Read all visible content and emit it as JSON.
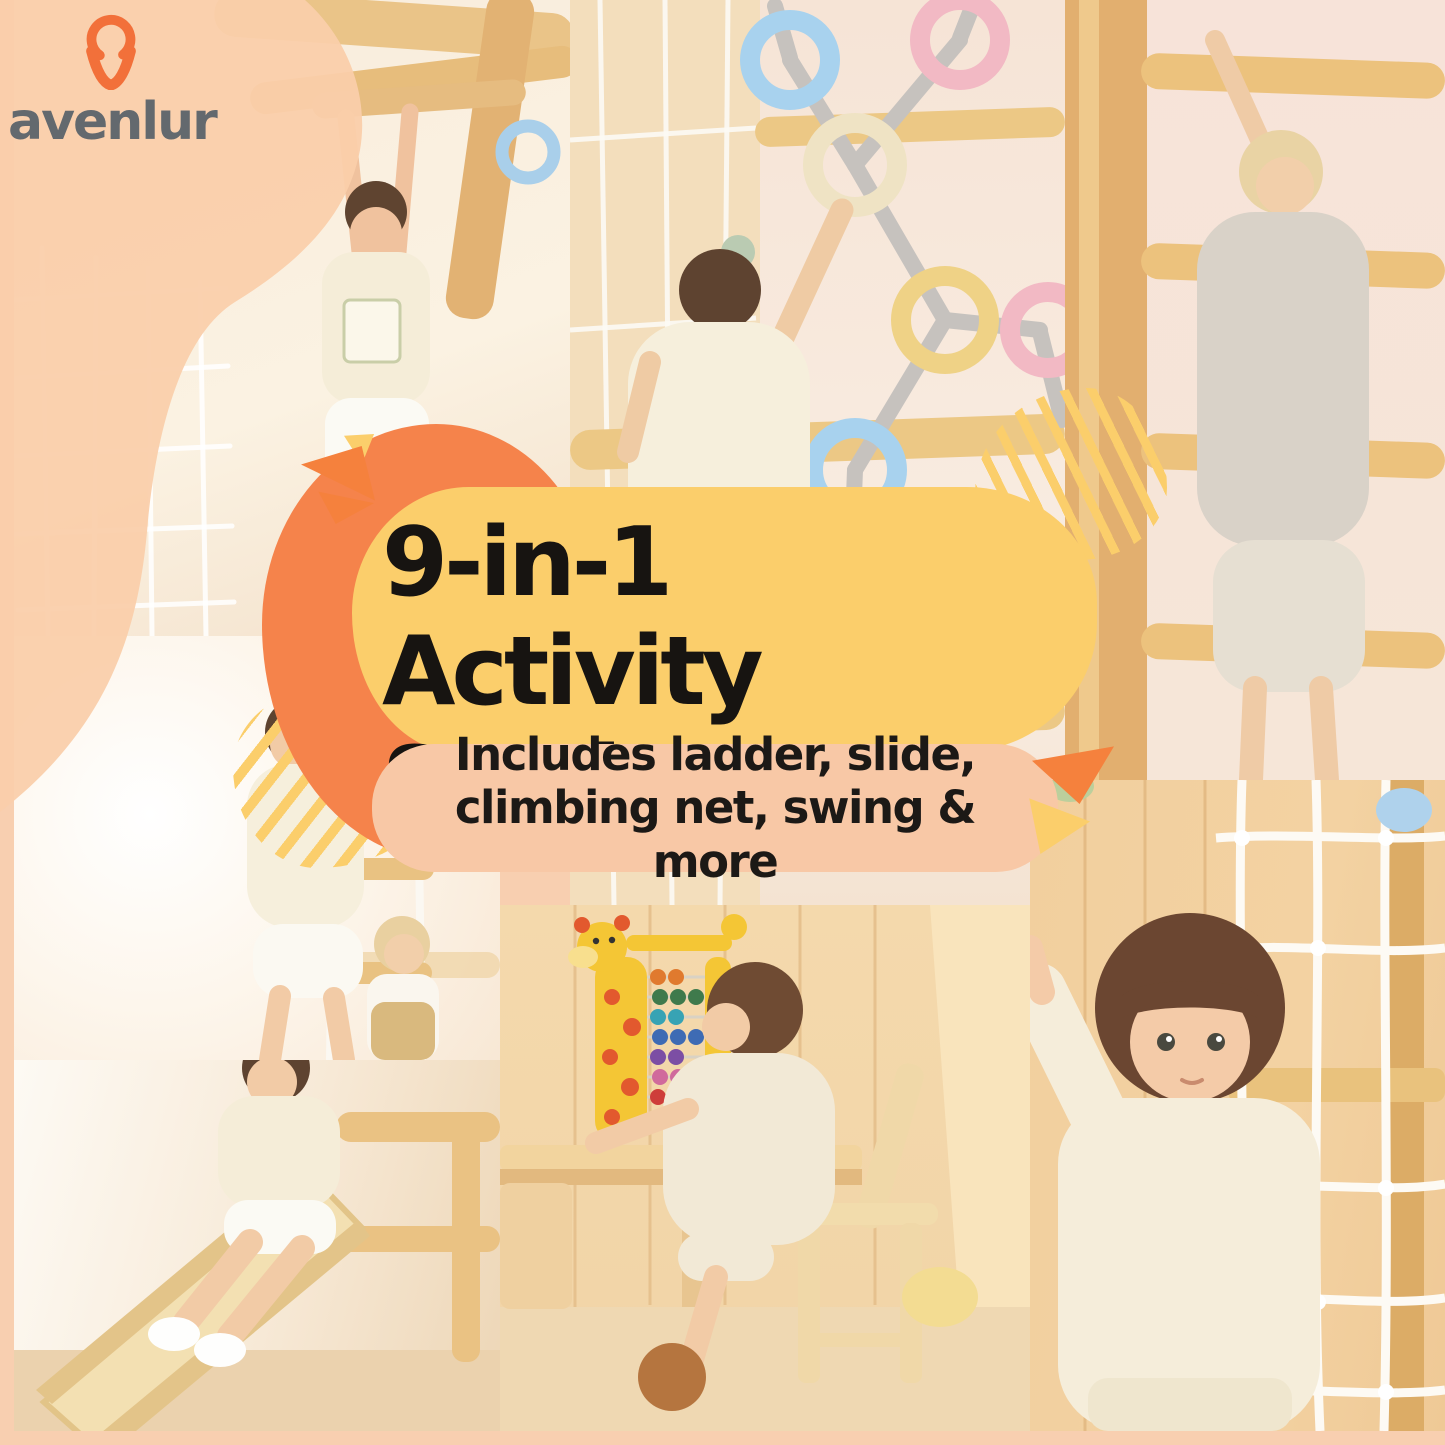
{
  "brand": {
    "name": "avenlur",
    "logo_icon": "avenlur-figure-icon"
  },
  "hero": {
    "title": "9-in-1 Activity Station",
    "subtitle": "Includes ladder, slide, climbing net, swing & more"
  },
  "colors": {
    "frame_peach": "#F8CFB0",
    "logo_blob_peach": "#FACDA9",
    "logo_text_gray": "#63696E",
    "logo_icon_orange": "#F2703A",
    "title_bubble_yellow": "#FBCE6B",
    "title_text": "#171411",
    "subtitle_bubble_peach": "#F8C8A6",
    "subtitle_text": "#1C1916",
    "accent_orange_blob": "#F5834B",
    "stripe_yellow": "#FBCE6B",
    "wood_light": "#ECC885",
    "ring_blue": "#A8D2EE",
    "ring_pink": "#F2B9C4",
    "ring_cream": "#EFE3C4",
    "ring_yellow": "#EFD286"
  },
  "photos": [
    {
      "id": "monkey-bars",
      "scene": "child hanging from wooden monkey bars"
    },
    {
      "id": "ring-wall",
      "scene": "girl climbing pastel ring wall"
    },
    {
      "id": "wall-bars",
      "scene": "blonde child climbing wooden wall bars"
    },
    {
      "id": "rope-ladder",
      "scene": "girl on rope ladder with toddler"
    },
    {
      "id": "slide",
      "scene": "girl sliding down wooden slide"
    },
    {
      "id": "abacus-desk",
      "scene": "child playing giraffe abacus at desk"
    },
    {
      "id": "climbing-wall",
      "scene": "boy at climbing wall with rope net"
    }
  ]
}
